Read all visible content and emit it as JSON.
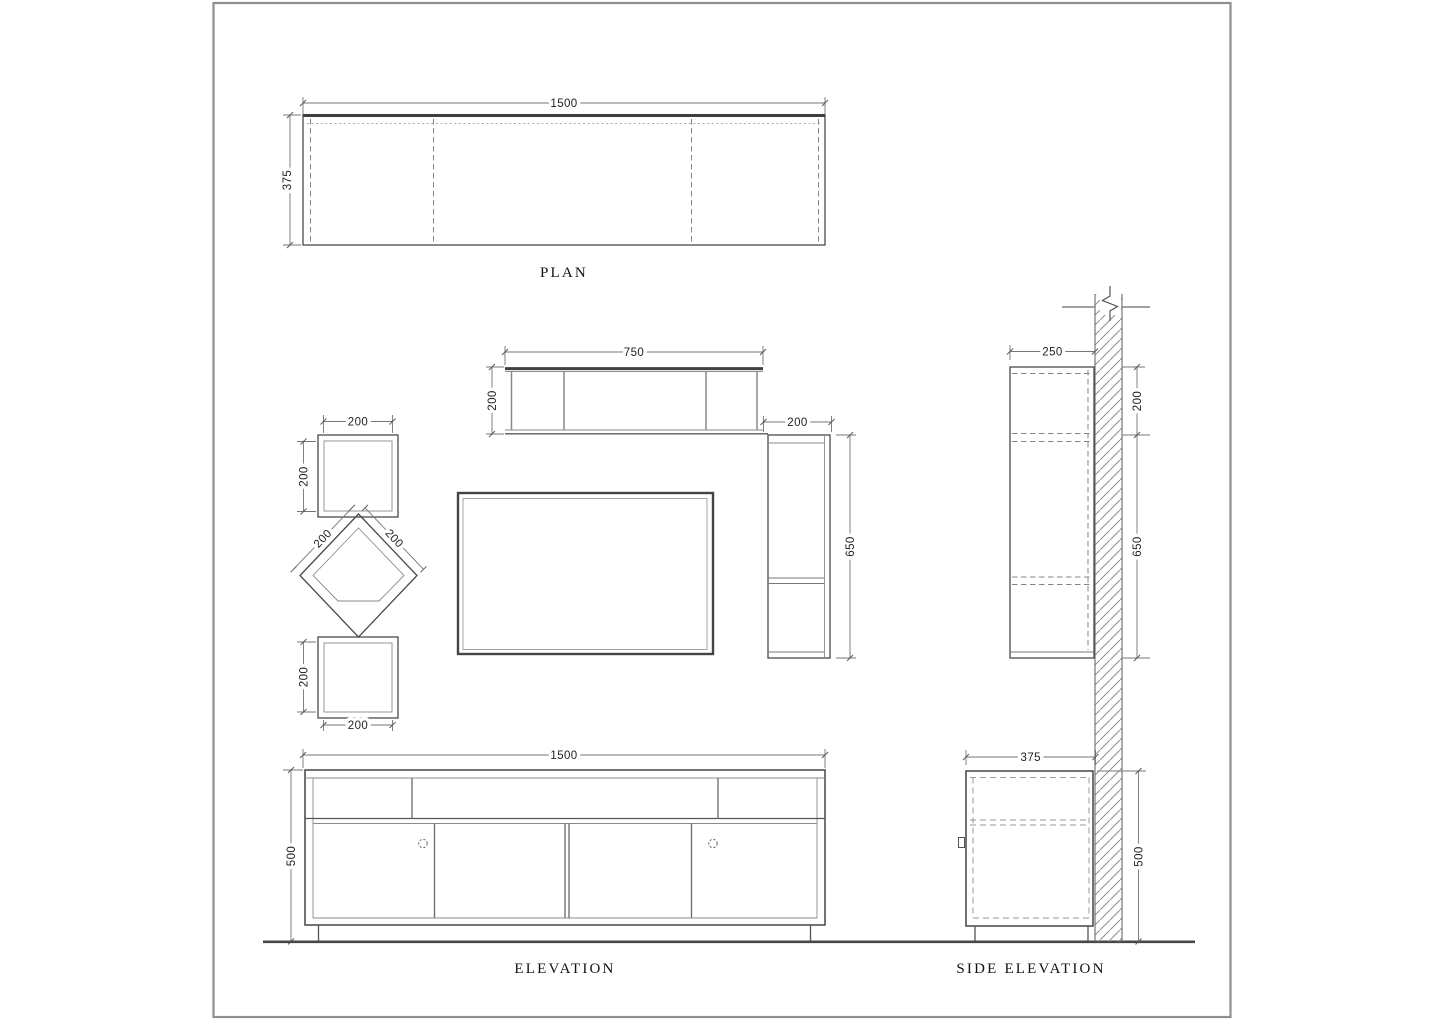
{
  "plan": {
    "title": "PLAN",
    "dim_width": "1500",
    "dim_depth": "375"
  },
  "elevation": {
    "title": "ELEVATION",
    "wall_shelf": {
      "dim_width": "750",
      "dim_height": "200"
    },
    "tall_unit": {
      "dim_width": "200",
      "dim_height": "650"
    },
    "square_shelf_top": {
      "dim_width": "200",
      "dim_height": "200"
    },
    "diamond_shelf": {
      "dim_left_edge": "200",
      "dim_right_edge": "200"
    },
    "square_shelf_bottom": {
      "dim_width": "200",
      "dim_height": "200"
    },
    "tv_cabinet": {
      "dim_width": "1500",
      "dim_height": "500"
    }
  },
  "side_elevation": {
    "title": "SIDE ELEVATION",
    "dim_shelf_depth": "250",
    "dim_shelf_height": "200",
    "dim_unit_height": "650",
    "dim_cabinet_depth": "375",
    "dim_cabinet_height": "500"
  },
  "colors": {
    "line": "#4a4a4a",
    "dim_line": "#767676",
    "dashed": "#8a8a8a",
    "text": "#1f1f1f",
    "page_border": "#8f8f8f",
    "background": "#ffffff"
  }
}
